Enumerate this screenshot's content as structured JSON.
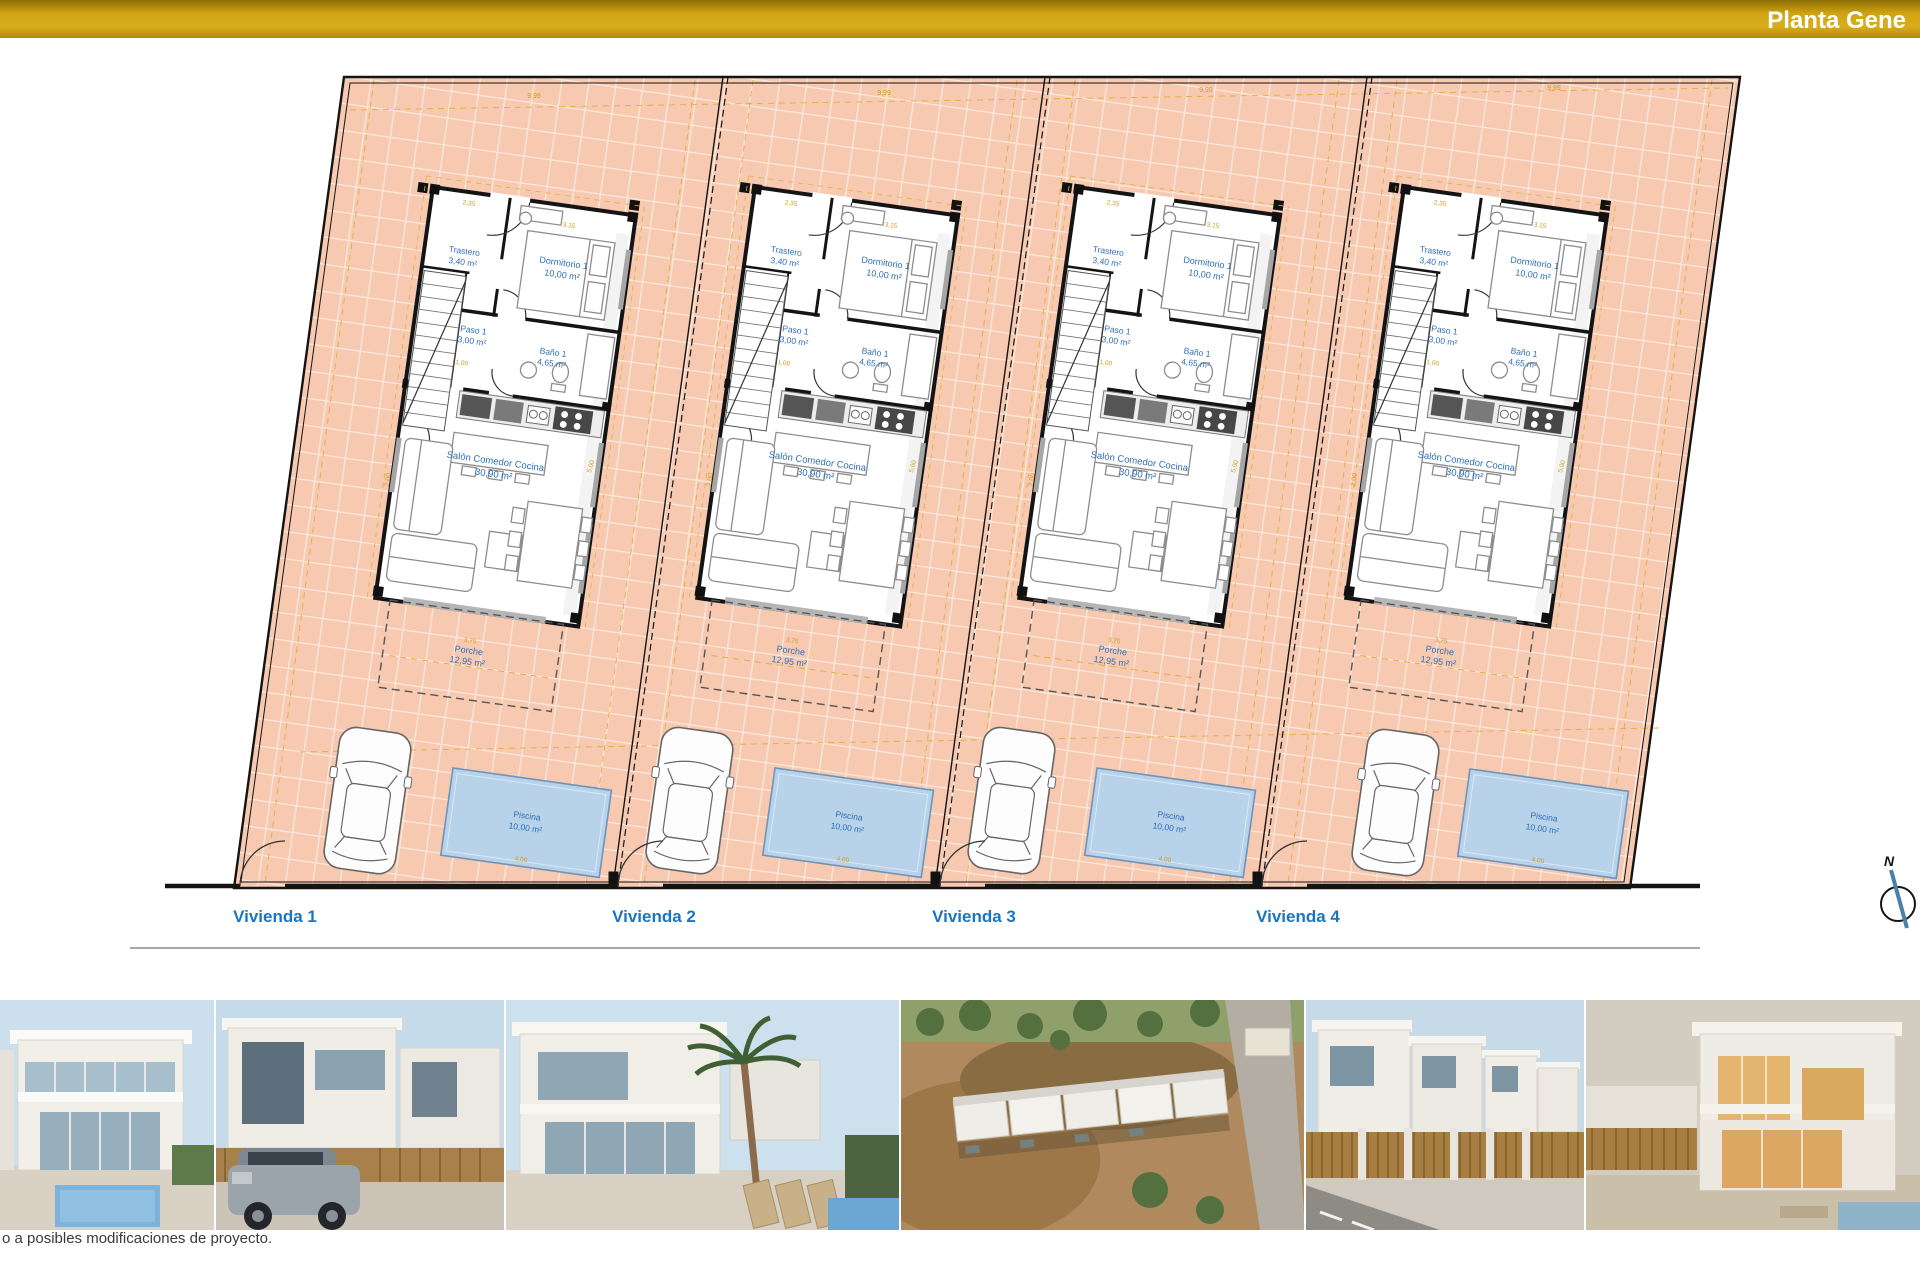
{
  "header": {
    "title": "Planta Gene"
  },
  "site": {
    "viviendas": [
      "Vivienda 1",
      "Vivienda 2",
      "Vivienda 3",
      "Vivienda 4"
    ],
    "compass_label": "N",
    "rooms": {
      "trastero": {
        "name": "Trastero",
        "area": "3,40 m²"
      },
      "dormitorio": {
        "name": "Dormitorio 1",
        "area": "10,00 m²"
      },
      "paso": {
        "name": "Paso 1",
        "area": "3,00 m²"
      },
      "bano": {
        "name": "Baño 1",
        "area": "4,65 m²"
      },
      "salon": {
        "name": "Salón Comedor Cocina",
        "area": "30,90 m²"
      },
      "porche": {
        "name": "Porche",
        "area": "12,95 m²"
      }
    },
    "pool": {
      "name": "Piscina",
      "area": "10,00 m²"
    },
    "dims": {
      "top": "9,99",
      "side": "2,00",
      "trastero": "2,35",
      "dormitorio": "3,15",
      "paso": "1,00",
      "salon": "5,00",
      "porche": "3,75",
      "pool": "4,00"
    }
  },
  "footer": {
    "disclaimer": "o a posibles modificaciones de proyecto."
  },
  "colors": {
    "bar_gold": "#c9990e",
    "plot_salmon": "#f6c9b0",
    "grid_line": "#fde9dd",
    "pool_blue": "#b7d2e9",
    "label_blue": "#2e6fb8",
    "dim_yellow": "#cf9f1d",
    "vivienda_blue": "#1b76c0"
  }
}
